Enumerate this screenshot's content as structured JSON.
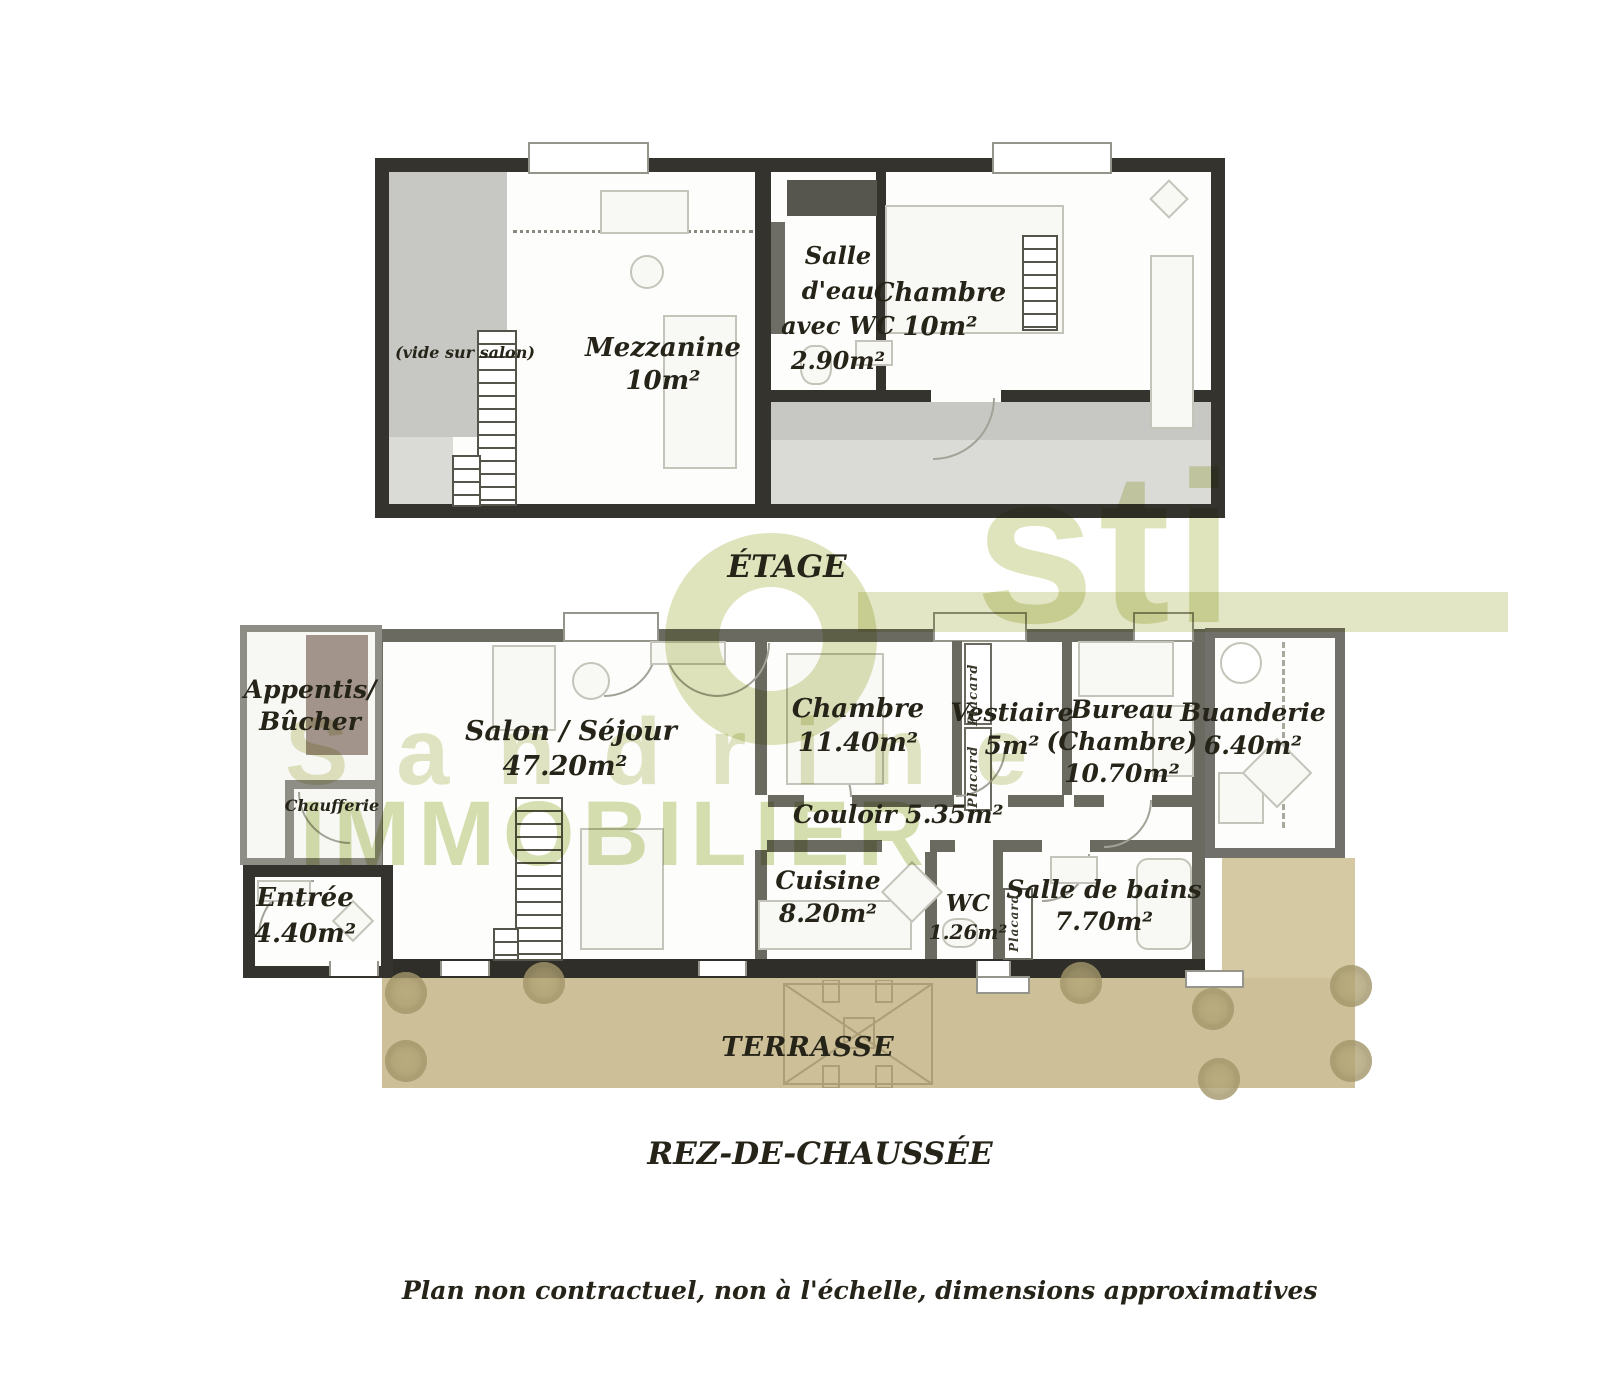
{
  "floors": {
    "etage": {
      "title": "ÉTAGE",
      "labels": {
        "vide": [
          "(vide sur salon)"
        ],
        "mezzanine": [
          "Mezzanine",
          "10m²"
        ],
        "salle_eau": [
          "Salle",
          "d'eau",
          "avec WC",
          "2.90m²"
        ],
        "chambre": [
          "Chambre",
          "10m²"
        ]
      }
    },
    "rdc": {
      "title": "REZ-DE-CHAUSSÉE",
      "labels": {
        "appentis": [
          "Appentis/",
          "Bûcher"
        ],
        "chaufferie": [
          "Chaufferie"
        ],
        "entree": [
          "Entrée",
          "4.40m²"
        ],
        "salon": [
          "Salon / Séjour",
          "47.20m²"
        ],
        "chambre": [
          "Chambre",
          "11.40m²"
        ],
        "vestiaire": [
          "Vestiaire",
          "5m²"
        ],
        "bureau": [
          "Bureau",
          "(Chambre)",
          "10.70m²"
        ],
        "buanderie": [
          "Buanderie",
          "6.40m²"
        ],
        "couloir": [
          "Couloir 5.35m²"
        ],
        "cuisine": [
          "Cuisine",
          "8.20m²"
        ],
        "wc": [
          "WC",
          "1.26m²"
        ],
        "salle_bains": [
          "Salle de bains",
          "7.70m²"
        ],
        "placard": "Placard",
        "terrasse": "TERRASSE"
      }
    }
  },
  "watermark": {
    "logo": "sti",
    "word1": "Sandrine",
    "word2": "IMMOBILIER",
    "color_olive": "#e0e4bd",
    "color_green": "#ccd79d"
  },
  "footer": {
    "disclaimer": "Plan non contractuel, non à l'échelle, dimensions approximatives"
  },
  "colors": {
    "wall_dark": "#34332d",
    "wall_mid": "#6b6a60",
    "terrace": "#cdc099",
    "terrace_light": "#d5c9a4",
    "void_gray": "#c7c7c3",
    "roof_gray": "#dadad6"
  }
}
